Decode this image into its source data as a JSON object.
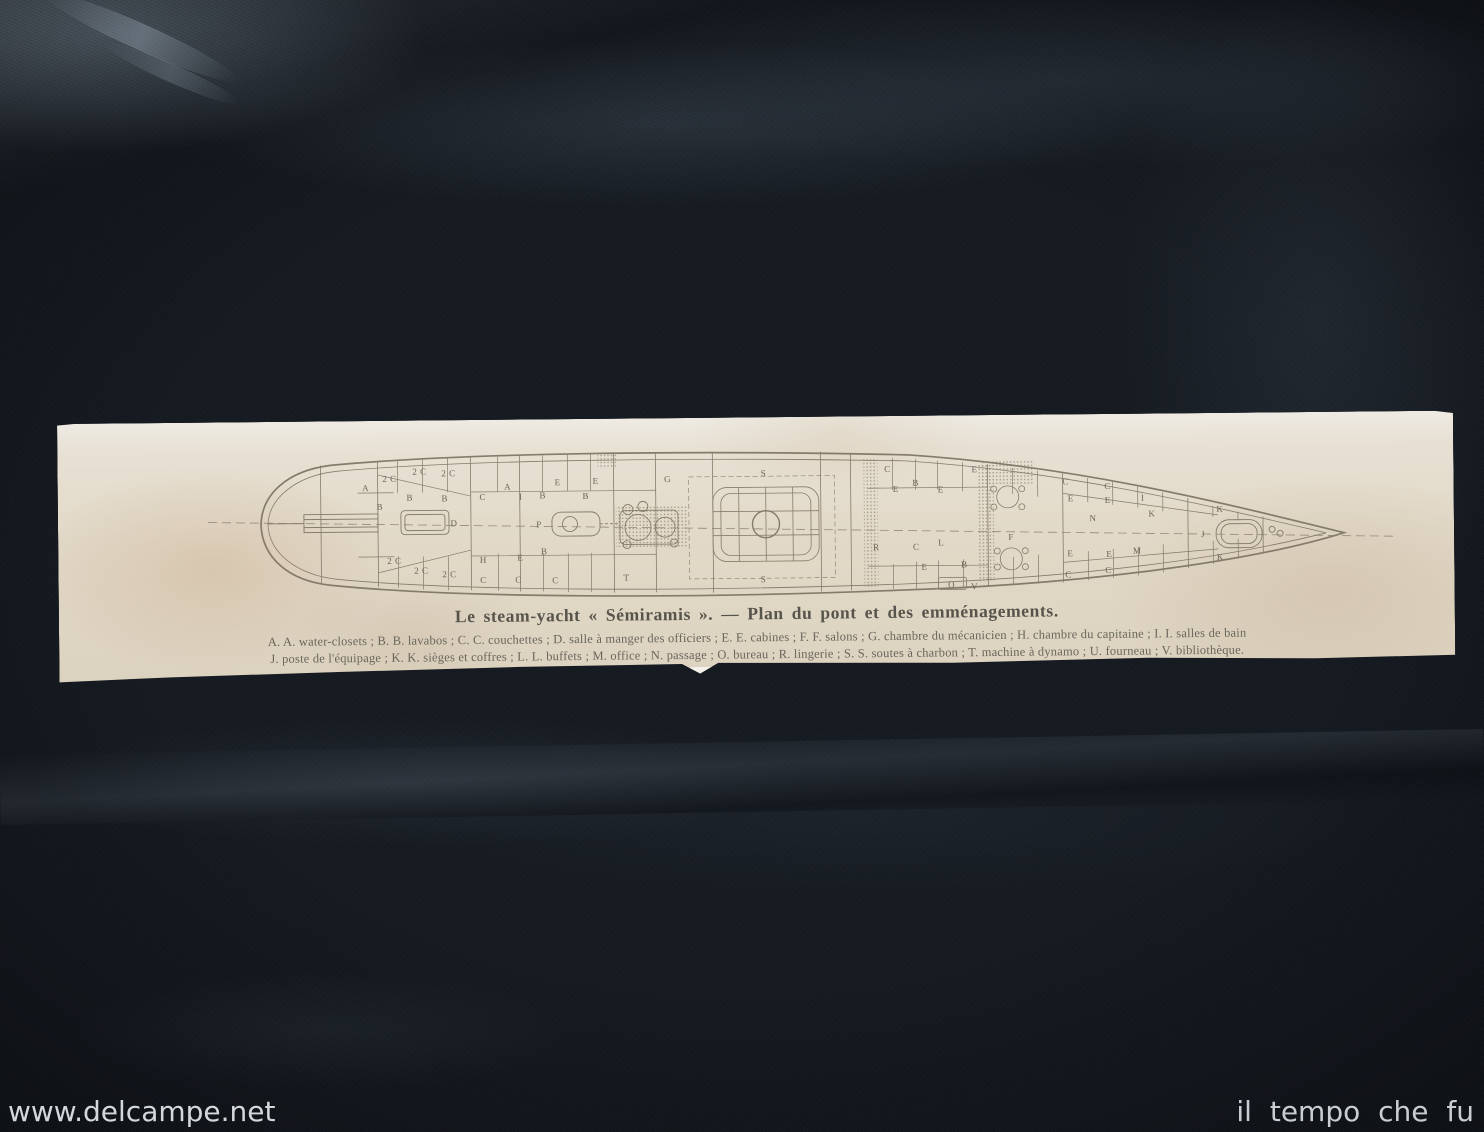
{
  "photo": {
    "watermark_left": "www.delcampe.net",
    "watermark_right": "il tempo che fu"
  },
  "print": {
    "caption": "Le steam-yacht « Sémiramis ». — Plan du pont et des emménagements.",
    "legend_line1": "A. A. water-closets ; B. B. lavabos ; C. C. couchettes ; D. salle à manger des officiers ; E. E. cabines ; F. F. salons ; G. chambre du mécanicien ; H. chambre du capitaine ; I. I. salles de bain",
    "legend_line2": "J. poste de l'équipage ; K. K. sièges et coffres ; L. L. buffets ; M. office ; N. passage ; O. bureau ; R. lingerie ; S. S. soutes à charbon ; T. machine à dynamo ; U. fourneau ; V. bibliothèque.",
    "plan": {
      "subject": "deck plan of steam-yacht Sémiramis, stern at left, bow at right",
      "labels": [
        {
          "t": "A",
          "x": 308,
          "y": 66
        },
        {
          "t": "2 C",
          "x": 332,
          "y": 57
        },
        {
          "t": "2 C",
          "x": 362,
          "y": 50
        },
        {
          "t": "2 C",
          "x": 391,
          "y": 52
        },
        {
          "t": "B",
          "x": 322,
          "y": 85
        },
        {
          "t": "B",
          "x": 352,
          "y": 76
        },
        {
          "t": "B",
          "x": 387,
          "y": 77
        },
        {
          "t": "D",
          "x": 396,
          "y": 102
        },
        {
          "t": "C",
          "x": 425,
          "y": 76
        },
        {
          "t": "A",
          "x": 450,
          "y": 66
        },
        {
          "t": "I",
          "x": 463,
          "y": 76
        },
        {
          "t": "B",
          "x": 485,
          "y": 75
        },
        {
          "t": "E",
          "x": 500,
          "y": 62
        },
        {
          "t": "B",
          "x": 528,
          "y": 76
        },
        {
          "t": "E",
          "x": 538,
          "y": 61
        },
        {
          "t": "P",
          "x": 481,
          "y": 104
        },
        {
          "t": "G",
          "x": 610,
          "y": 60
        },
        {
          "t": "H",
          "x": 425,
          "y": 139
        },
        {
          "t": "E",
          "x": 462,
          "y": 137
        },
        {
          "t": "B",
          "x": 486,
          "y": 131
        },
        {
          "t": "2 C",
          "x": 336,
          "y": 139
        },
        {
          "t": "2 C",
          "x": 363,
          "y": 149
        },
        {
          "t": "2 C",
          "x": 391,
          "y": 153
        },
        {
          "t": "C",
          "x": 425,
          "y": 159
        },
        {
          "t": "C",
          "x": 460,
          "y": 159
        },
        {
          "t": "C",
          "x": 497,
          "y": 160
        },
        {
          "t": "T",
          "x": 568,
          "y": 158
        },
        {
          "t": "S",
          "x": 706,
          "y": 55
        },
        {
          "t": "S",
          "x": 705,
          "y": 161
        },
        {
          "t": "C",
          "x": 830,
          "y": 52
        },
        {
          "t": "E",
          "x": 838,
          "y": 72
        },
        {
          "t": "B",
          "x": 858,
          "y": 66
        },
        {
          "t": "E",
          "x": 883,
          "y": 73
        },
        {
          "t": "E",
          "x": 917,
          "y": 53
        },
        {
          "t": "R",
          "x": 818,
          "y": 130
        },
        {
          "t": "C",
          "x": 858,
          "y": 130
        },
        {
          "t": "L",
          "x": 883,
          "y": 126
        },
        {
          "t": "E",
          "x": 866,
          "y": 150
        },
        {
          "t": "B",
          "x": 906,
          "y": 148
        },
        {
          "t": "O",
          "x": 893,
          "y": 168
        },
        {
          "t": "V",
          "x": 916,
          "y": 170
        },
        {
          "t": "F",
          "x": 953,
          "y": 121
        },
        {
          "t": "C",
          "x": 1008,
          "y": 66
        },
        {
          "t": "E",
          "x": 1013,
          "y": 83
        },
        {
          "t": "C",
          "x": 1050,
          "y": 71
        },
        {
          "t": "E",
          "x": 1050,
          "y": 85
        },
        {
          "t": "N",
          "x": 1035,
          "y": 103
        },
        {
          "t": "I",
          "x": 1085,
          "y": 83
        },
        {
          "t": "K",
          "x": 1094,
          "y": 99
        },
        {
          "t": "E",
          "x": 1012,
          "y": 138
        },
        {
          "t": "E",
          "x": 1051,
          "y": 139
        },
        {
          "t": "M",
          "x": 1079,
          "y": 136
        },
        {
          "t": "C",
          "x": 1010,
          "y": 159
        },
        {
          "t": "C",
          "x": 1050,
          "y": 155
        },
        {
          "t": "K",
          "x": 1162,
          "y": 95
        },
        {
          "t": "K",
          "x": 1162,
          "y": 143
        },
        {
          "t": "J",
          "x": 1145,
          "y": 120
        }
      ]
    }
  },
  "colors": {
    "ink": "#847b6b",
    "paper": "#e2d9c8",
    "fabric": "#161b22",
    "watermark": "#d3d8db"
  }
}
